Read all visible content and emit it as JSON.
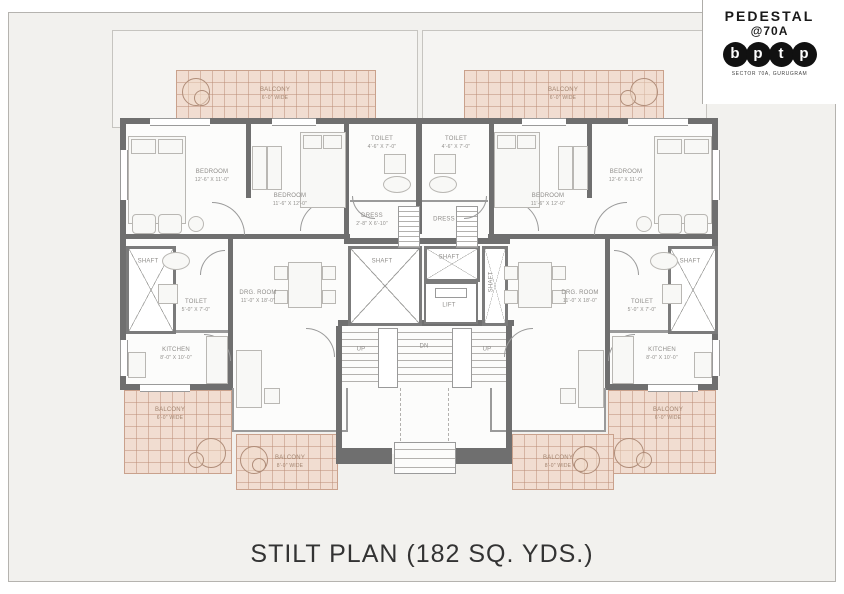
{
  "sheet": {
    "title": "STILT PLAN (182 SQ. YDS.)"
  },
  "logo": {
    "line1": "PEDESTAL",
    "line2": "@70A",
    "letters": [
      "b",
      "p",
      "t",
      "p"
    ],
    "subtitle": "SECTOR 70A, GURUGRAM"
  },
  "colors": {
    "wall": "#6f6f6f",
    "paper": "#f2f1ee",
    "balcony_fill": "#f1ddd1",
    "balcony_line": "#c9a18c",
    "label": "#8f8d8a"
  },
  "rooms": {
    "bedroom_outer": {
      "name": "BEDROOM",
      "dims": "12'-6\" X 11'-0\""
    },
    "bedroom_inner": {
      "name": "BEDROOM",
      "dims": "11'-6\" X 12'-0\""
    },
    "toilet_top": {
      "name": "TOILET",
      "dims": "4'-6\" X 7'-0\""
    },
    "dress": {
      "name": "DRESS",
      "dims": "2'-8\" X 6'-10\""
    },
    "toilet_side": {
      "name": "TOILET",
      "dims": "5'-0\" X 7'-0\""
    },
    "kitchen": {
      "name": "KITCHEN",
      "dims": "8'-0\" X 10'-0\""
    },
    "drg_room": {
      "name": "DRG. ROOM",
      "dims": "11'-0\" X 18'-0\""
    },
    "shaft": {
      "name": "SHAFT"
    },
    "lift": {
      "name": "LIFT"
    },
    "balcony_6": {
      "name": "BALCONY",
      "dims": "6'-0\" WIDE"
    },
    "balcony_8": {
      "name": "BALCONY",
      "dims": "8'-0\" WIDE"
    },
    "stairs": {
      "up": "UP",
      "dn": "DN"
    }
  }
}
